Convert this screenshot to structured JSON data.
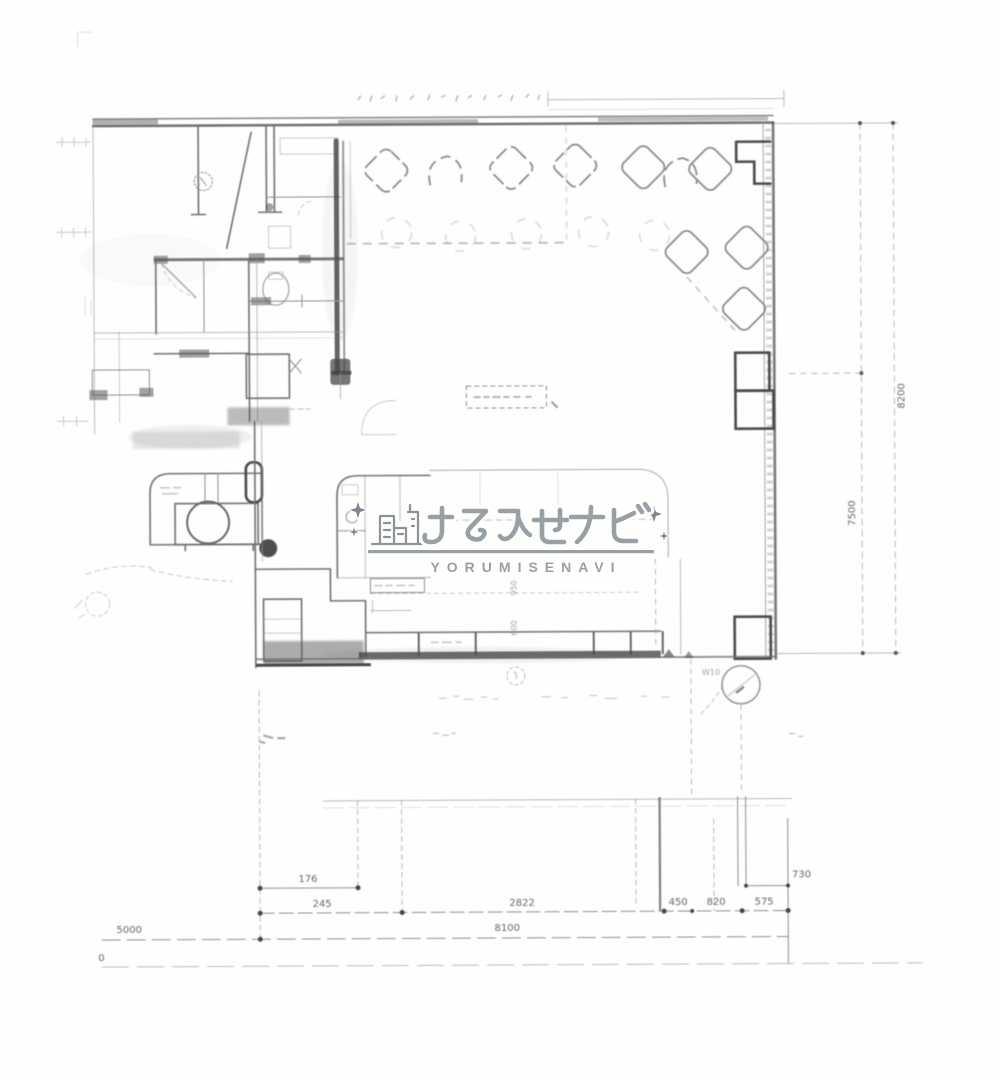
{
  "watermark": {
    "jp": "よるみせナビ",
    "en": "YORUMISENAVI",
    "color": "#98a0a4",
    "icon": "city-skyline-icon",
    "sparkle": "sparkle-icon"
  },
  "dimensions": {
    "d176": "176",
    "d245": "245",
    "d2822": "2822",
    "d450": "450",
    "d820": "820",
    "d575": "575",
    "d730": "730",
    "d5000": "5000",
    "d8100": "8100",
    "dzero": "0",
    "v7500": "7500",
    "v8200": "8200",
    "c950": "950",
    "c600": "600",
    "w10": "W10"
  }
}
